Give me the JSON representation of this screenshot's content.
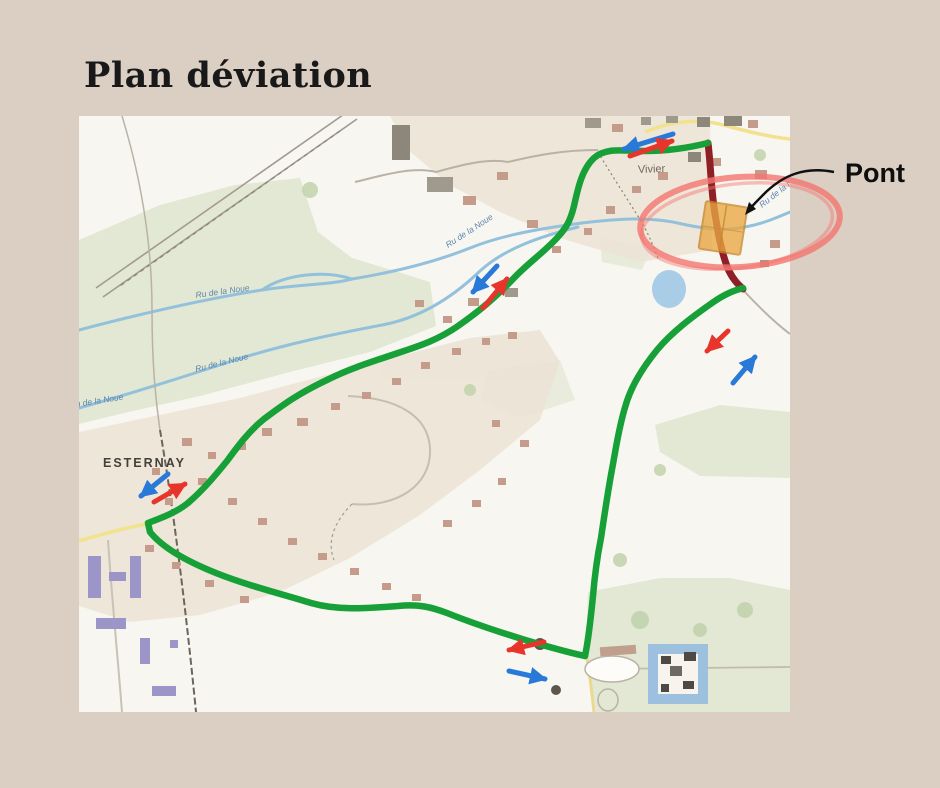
{
  "page": {
    "title": "Plan déviation"
  },
  "map": {
    "place_labels": {
      "village": "Vivier",
      "town": "ESTERNAY",
      "river": "Ru de la Noue"
    },
    "callout": {
      "label": "Pont"
    }
  },
  "annotations": {
    "detour_route": "thick green line looping west through Vivier and Esternay then back north-east",
    "closed_section": "dark red line through the bridge",
    "bridge_marker": "orange rectangle circled by a red hand-drawn ellipse",
    "direction_arrows": [
      {
        "area": "north, near Vivier",
        "blue": "points south-west",
        "red": "points north-east"
      },
      {
        "area": "mid slope, above river",
        "blue": "points south-west",
        "red": "points north-east"
      },
      {
        "area": "Esternay",
        "blue": "points south-west",
        "red": "points north-east"
      },
      {
        "area": "east branch",
        "red": "points south-west",
        "blue": "points north-east"
      },
      {
        "area": "south road",
        "red": "points west",
        "blue": "points east"
      }
    ]
  },
  "colors": {
    "page_bg": "#dbcec3",
    "title_color": "#191919",
    "map_bg": "#f8f6f1",
    "field_green": "#e2e8d3",
    "urban_beige": "#ece4d6",
    "river_blue": "#93c1dc",
    "road_yellow": "#f2e28e",
    "route_green": "#18a038",
    "closed_red": "#8e1f26",
    "bridge_orange": "#eaa844",
    "ellipse_red": "#f3756f",
    "arrow_blue": "#2979d9",
    "arrow_red": "#e8352b",
    "label_blue": "#5c86ad"
  }
}
